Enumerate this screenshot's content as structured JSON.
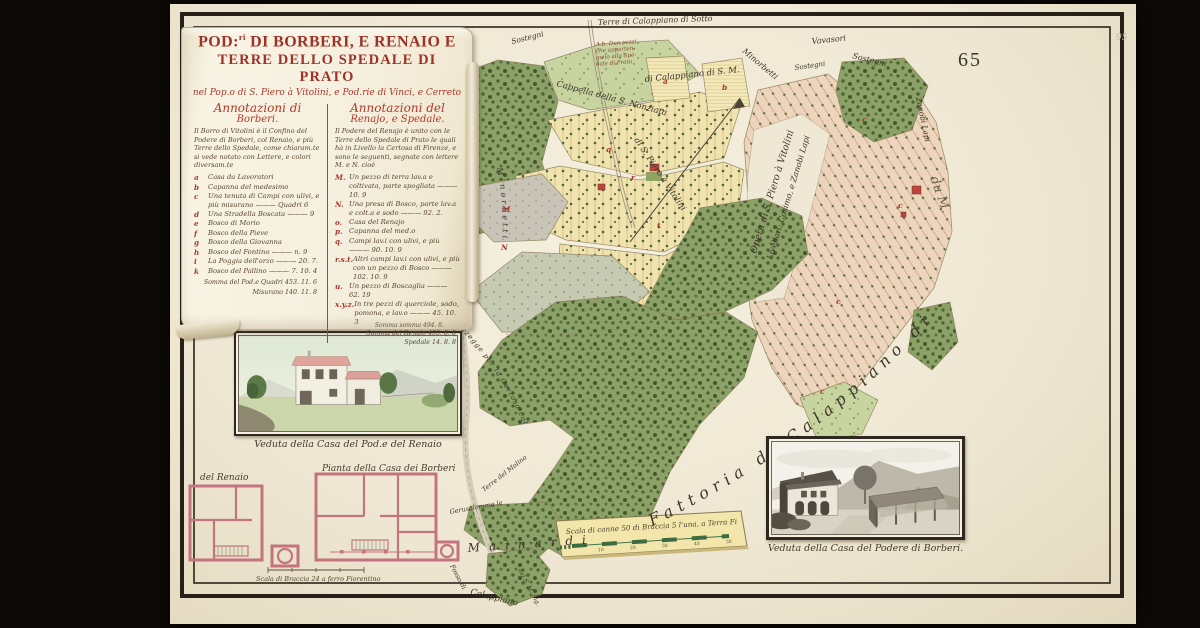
{
  "scan": {
    "sheet_number": "65",
    "corner_note": "95"
  },
  "cartouche": {
    "title_line1_pre": "POD:",
    "title_line1_sup": "ri",
    "title_line1_rest": " DI BORBERI, E RENAIO E",
    "title_line2": "TERRE DELLO SPEDALE DI PRATO",
    "subtitle": "nel Pop.o di S. Piero à Vitolini, e Pod.rie di Vinci, e Cerreto",
    "col_left": {
      "heading_line1": "Annotazioni di",
      "heading_line2": "Borberi.",
      "intro": "Il Borro di Vitolini è il Confino del Podere di Borberi, col Renaio, e più Terre dello Spedale, come chiaram.te si vede notato con Lettere, e colori diversam.te",
      "items": [
        {
          "key": "a",
          "text": "Casa da Lavoratori"
        },
        {
          "key": "b",
          "text": "Capanna del medesimo"
        },
        {
          "key": "c",
          "text": "Una tenuta di Campi con ulivi, e più misurano ——— Quadri 6"
        },
        {
          "key": "d",
          "text": "Una Stradella Boscata ——— 9"
        },
        {
          "key": "e",
          "text": "Bosco di Morio"
        },
        {
          "key": "f",
          "text": "Bosco della Pieve"
        },
        {
          "key": "g",
          "text": "Bosco della Giovanna"
        },
        {
          "key": "h",
          "text": "Bosco del Fontino ——— n. 9"
        },
        {
          "key": "i",
          "text": "La Poggia dell'orzo ——— 20. 7."
        },
        {
          "key": "k",
          "text": "Bosco del Pallino ——— 7. 10. 4"
        }
      ],
      "totals": [
        "Somma del Pod.e  Quadri 453. 11. 6",
        "Misurano 140. 11. 8"
      ]
    },
    "col_right": {
      "heading_line1": "Annotazioni del",
      "heading_line2": "Renajo, e Spedale.",
      "intro": "Il Podere del Renajo è unito con le Terre dello Spedale di Prato le quali hà in Livello la Certosa di Firenze, e sono le seguenti, segnate con lettere M. e N. cioè",
      "items": [
        {
          "key": "M.",
          "text": "Un pezzo di terra lav.a e coltivata, parte spogliata ——— 10. 9"
        },
        {
          "key": "N.",
          "text": "Una presa di Bosco, parte lav.a e colt.a e sodo ——— 92. 2."
        },
        {
          "key": "o.",
          "text": "Casa del Renajo"
        },
        {
          "key": "p.",
          "text": "Capanna del med.o"
        },
        {
          "key": "q.",
          "text": "Campi lav.i con ulivi, e più ——— 90. 10. 9"
        },
        {
          "key": "r.s.t.",
          "text": "Altri campi lav.i con ulivi, e più con un pezzo di Bosco ——— 102. 10. 9"
        },
        {
          "key": "u.",
          "text": "Un pezzo di Boscaglia ——— 62. 19"
        },
        {
          "key": "x.y.z.",
          "text": "In tre pezzi di querciole, sodo, pomona, e lav.o ——— 45. 10. 3"
        }
      ],
      "totals": [
        "Somma del Renaio 453. 8. 8",
        "Spedale 14. 8. 8"
      ]
    },
    "footnote": "Somma somma 494. 8."
  },
  "pictures": {
    "renaio_view_caption": "Veduta della Casa del Pod.e del Renaio",
    "borberi_view_caption": "Veduta della Casa del Podere di Borberi."
  },
  "plans": {
    "renaio_label": "del Renaio",
    "borberi_label": "Pianta della Casa dei Borberi",
    "scale_caption": "Scala di Braccia 24 a ferro Fiorentino"
  },
  "scalebar": {
    "caption": "Scala di canne 50 di Braccia 5 l'una, a Terra Fior.a",
    "ticks": [
      "10",
      "20",
      "30",
      "40",
      "50"
    ]
  },
  "map": {
    "textpaths": {
      "fattoria": "Fattoria di Calappiano di",
      "minorbetti": "Minorbetti",
      "imperiali": "Imperiali",
      "certosa": "Mozzegge per la Certosa col"
    },
    "note_lines": [
      "A.b. Due pezzi",
      "che apparten-",
      "gono allo Spe-",
      "dale di Prato"
    ],
    "labels": [
      {
        "t": "Terre di Calappiano di Sotto",
        "x": 598,
        "y": 25,
        "r": -2,
        "s": 8
      },
      {
        "t": "di Calappiano di S. M.",
        "x": 645,
        "y": 82,
        "r": -6,
        "s": 8.5
      },
      {
        "t": "Minorbetti",
        "x": 742,
        "y": 52,
        "r": 40,
        "s": 8
      },
      {
        "t": "Sostegni",
        "x": 512,
        "y": 44,
        "r": -14,
        "s": 7.5
      },
      {
        "t": "Sostegni",
        "x": 795,
        "y": 70,
        "r": -8,
        "s": 7
      },
      {
        "t": "Sostegni",
        "x": 852,
        "y": 58,
        "r": 14,
        "s": 8
      },
      {
        "t": "Vavasori",
        "x": 812,
        "y": 44,
        "r": -6,
        "s": 8
      },
      {
        "t": "Cappella della S. Nonziata",
        "x": 556,
        "y": 86,
        "r": 15,
        "s": 8.5
      },
      {
        "t": "di S. Piero à Vitolini",
        "x": 634,
        "y": 140,
        "r": 56,
        "s": 8.5
      },
      {
        "t": "Opera di S. Piero à Vitolini",
        "x": 756,
        "y": 254,
        "r": -73,
        "s": 9.5
      },
      {
        "t": "Livellari: Cosimo, e Zanobi Lapi",
        "x": 772,
        "y": 260,
        "r": -73,
        "s": 8
      },
      {
        "t": "Zanobi Lapi",
        "x": 916,
        "y": 98,
        "r": 78,
        "s": 7.5
      },
      {
        "t": "du M.",
        "x": 930,
        "y": 178,
        "r": 70,
        "s": 13,
        "cls": "faint2"
      },
      {
        "t": "Terre del Molino",
        "x": 484,
        "y": 492,
        "r": -38,
        "s": 6.5
      },
      {
        "t": "Gerusalemme le",
        "x": 450,
        "y": 514,
        "r": -10,
        "s": 6.5
      },
      {
        "t": "Fosso di",
        "x": 450,
        "y": 566,
        "r": 62,
        "s": 6.5
      },
      {
        "t": "Calappiano",
        "x": 470,
        "y": 594,
        "r": 14,
        "s": 8.5
      },
      {
        "t": "del S. M. Sig.",
        "x": 518,
        "y": 570,
        "r": 62,
        "s": 6
      },
      {
        "t": "Mainardi",
        "x": 468,
        "y": 552,
        "r": -4,
        "s": 12,
        "sp": 9
      }
    ],
    "letters": [
      {
        "t": "a",
        "x": 663,
        "y": 84
      },
      {
        "t": "b",
        "x": 722,
        "y": 90
      },
      {
        "t": "q",
        "x": 606,
        "y": 152
      },
      {
        "t": "r",
        "x": 631,
        "y": 180
      },
      {
        "t": "t",
        "x": 657,
        "y": 228
      },
      {
        "t": "M",
        "x": 502,
        "y": 212
      },
      {
        "t": "N",
        "x": 501,
        "y": 250
      },
      {
        "t": "c",
        "x": 836,
        "y": 304
      },
      {
        "t": "c",
        "x": 898,
        "y": 208
      },
      {
        "t": "c",
        "x": 862,
        "y": 122
      },
      {
        "t": "c",
        "x": 820,
        "y": 394
      }
    ]
  }
}
